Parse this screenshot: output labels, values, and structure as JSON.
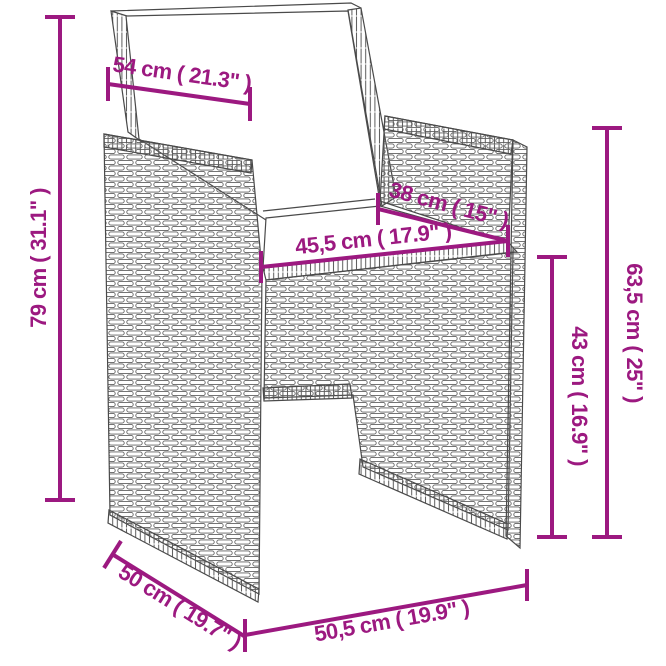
{
  "diagram": {
    "description": "Poly rattan garden chair with white cushions - dimension diagram",
    "accent_color": "#9C1980",
    "line_color": "#4A4A4A",
    "background_color": "#FFFFFF"
  },
  "measurements": {
    "back_width": {
      "label": "54 cm ( 21.3\" )"
    },
    "total_height": {
      "label": "79 cm ( 31.1\" )"
    },
    "seat_depth": {
      "label": "38 cm ( 15\" )"
    },
    "seat_width": {
      "label": "45,5 cm ( 17.9\" )"
    },
    "armrest_height": {
      "label": "63,5 cm ( 25\" )"
    },
    "seat_height": {
      "label": "43 cm ( 16.9\" )"
    },
    "chair_depth": {
      "label": "50 cm ( 19.7\" )"
    },
    "chair_width": {
      "label": "50,5 cm ( 19.9\" )"
    }
  }
}
